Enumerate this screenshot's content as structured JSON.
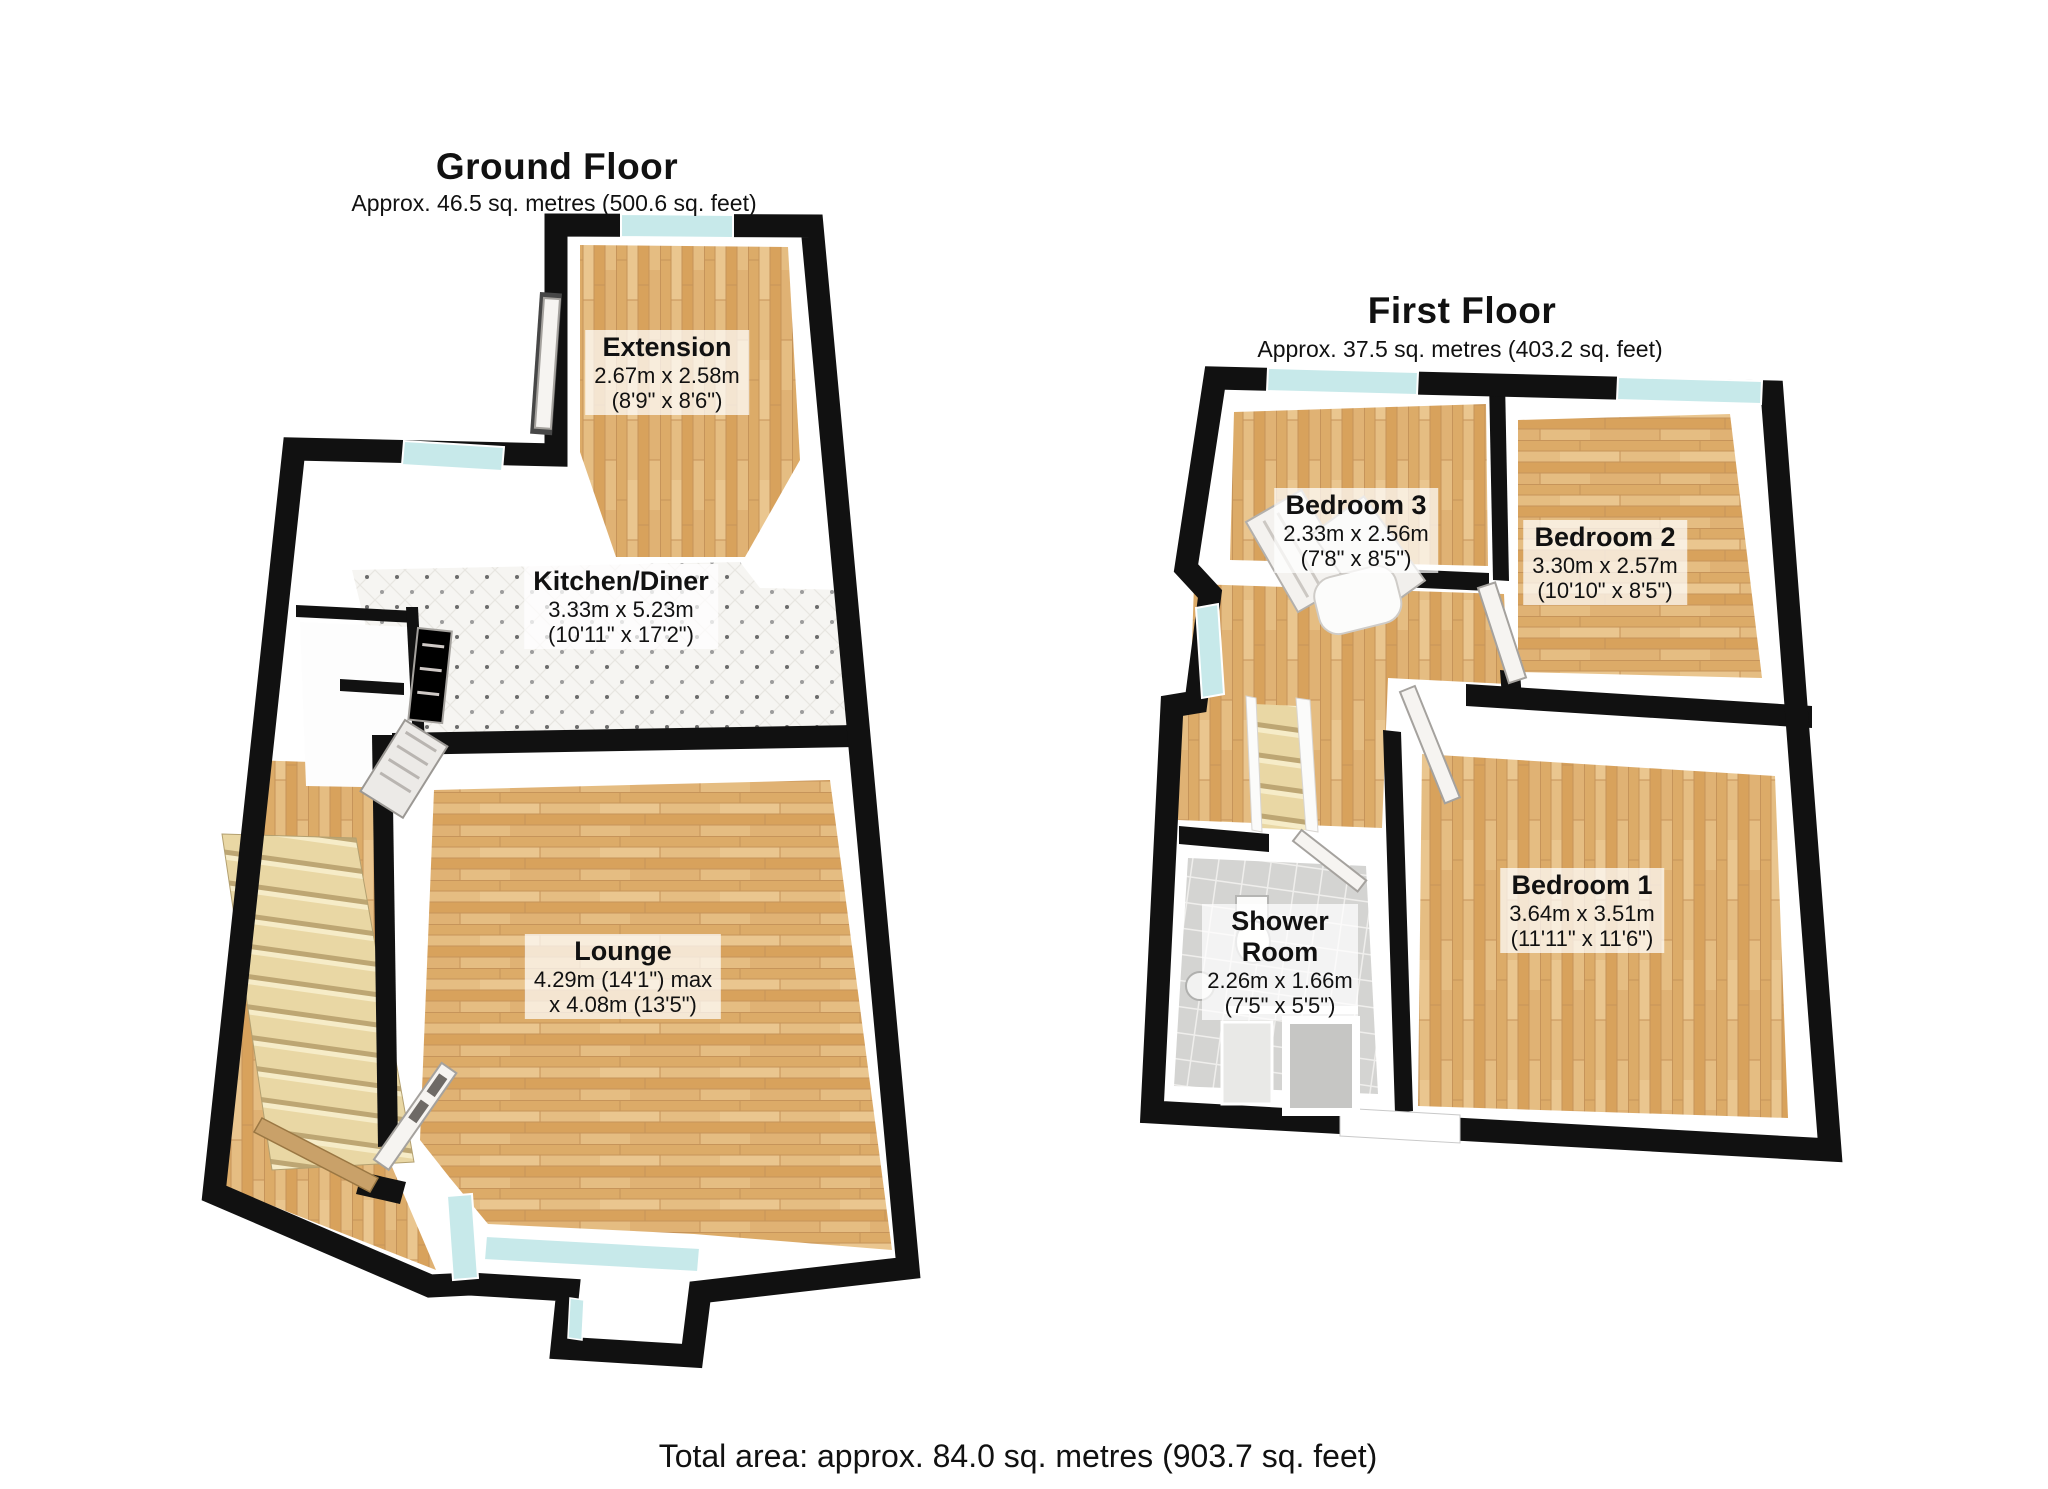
{
  "ground_floor": {
    "title": "Ground Floor",
    "subtitle": "Approx. 46.5 sq. metres (500.6 sq. feet)",
    "rooms": {
      "extension": {
        "name": "Extension",
        "dims1": "2.67m x 2.58m",
        "dims2": "(8'9\" x 8'6\")"
      },
      "kitchen": {
        "name": "Kitchen/Diner",
        "dims1": "3.33m x 5.23m",
        "dims2": "(10'11\" x 17'2\")"
      },
      "lounge": {
        "name": "Lounge",
        "dims1": "4.29m (14'1\") max",
        "dims2": "x 4.08m (13'5\")"
      }
    }
  },
  "first_floor": {
    "title": "First Floor",
    "subtitle": "Approx. 37.5 sq. metres (403.2 sq. feet)",
    "rooms": {
      "bedroom3": {
        "name": "Bedroom 3",
        "dims1": "2.33m x 2.56m",
        "dims2": "(7'8\" x 8'5\")"
      },
      "bedroom2": {
        "name": "Bedroom 2",
        "dims1": "3.30m x 2.57m",
        "dims2": "(10'10\" x 8'5\")"
      },
      "bedroom1": {
        "name": "Bedroom 1",
        "dims1": "3.64m x 3.51m",
        "dims2": "(11'11\" x 11'6\")"
      },
      "shower": {
        "name": "Shower Room",
        "dims1": "2.26m x 1.66m",
        "dims2": "(7'5\" x 5'5\")"
      }
    }
  },
  "footer": {
    "total_area": "Total area: approx. 84.0 sq. metres (903.7 sq. feet)"
  },
  "colors": {
    "wall": "#111111",
    "wood_floor": "#e2b97e",
    "window_glass": "#c7e9ea",
    "kitchen_tile": "#f6f5f2",
    "shower_tile": "#d4d4d2",
    "stair_tread": "#e9d7a4",
    "label_background": "#ffffff"
  }
}
